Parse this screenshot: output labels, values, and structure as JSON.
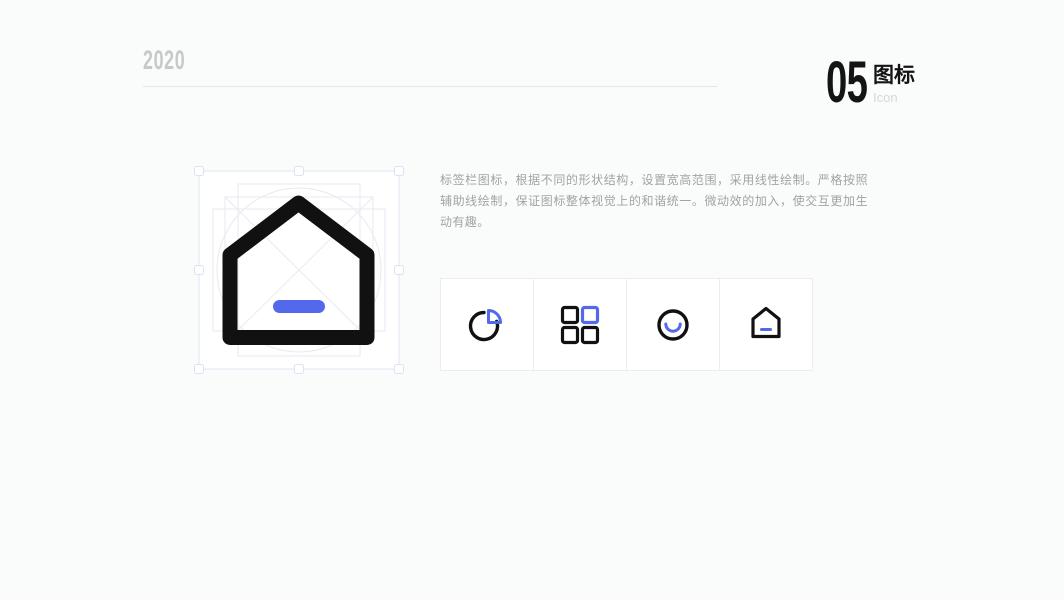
{
  "header": {
    "year": "2020",
    "section_number": "05",
    "section_title_zh": "图标",
    "section_title_en": "Icon"
  },
  "description": "标签栏图标，根据不同的形状结构，设置宽高范围，采用线性绘制。严格按照辅助线绘制，保证图标整体视觉上的和谐统一。微动效的加入，使交互更加生动有趣。",
  "artboard": {
    "icon_name": "home-tab-icon",
    "guides": [
      "circle-keyline",
      "square-keyline",
      "portrait-rect-keyline",
      "landscape-rect-keyline",
      "diagonal-cross"
    ],
    "selection_handles": 8
  },
  "icon_gallery": [
    {
      "name": "pie-chart-icon"
    },
    {
      "name": "category-grid-icon"
    },
    {
      "name": "smile-circle-icon"
    },
    {
      "name": "home-icon"
    }
  ],
  "colors": {
    "accent_blue": "#5468eb",
    "icon_black": "#111111",
    "page_bg": "#fafbfb",
    "muted_text": "#a3a3a3",
    "faint_gray": "#c8c8c8"
  }
}
